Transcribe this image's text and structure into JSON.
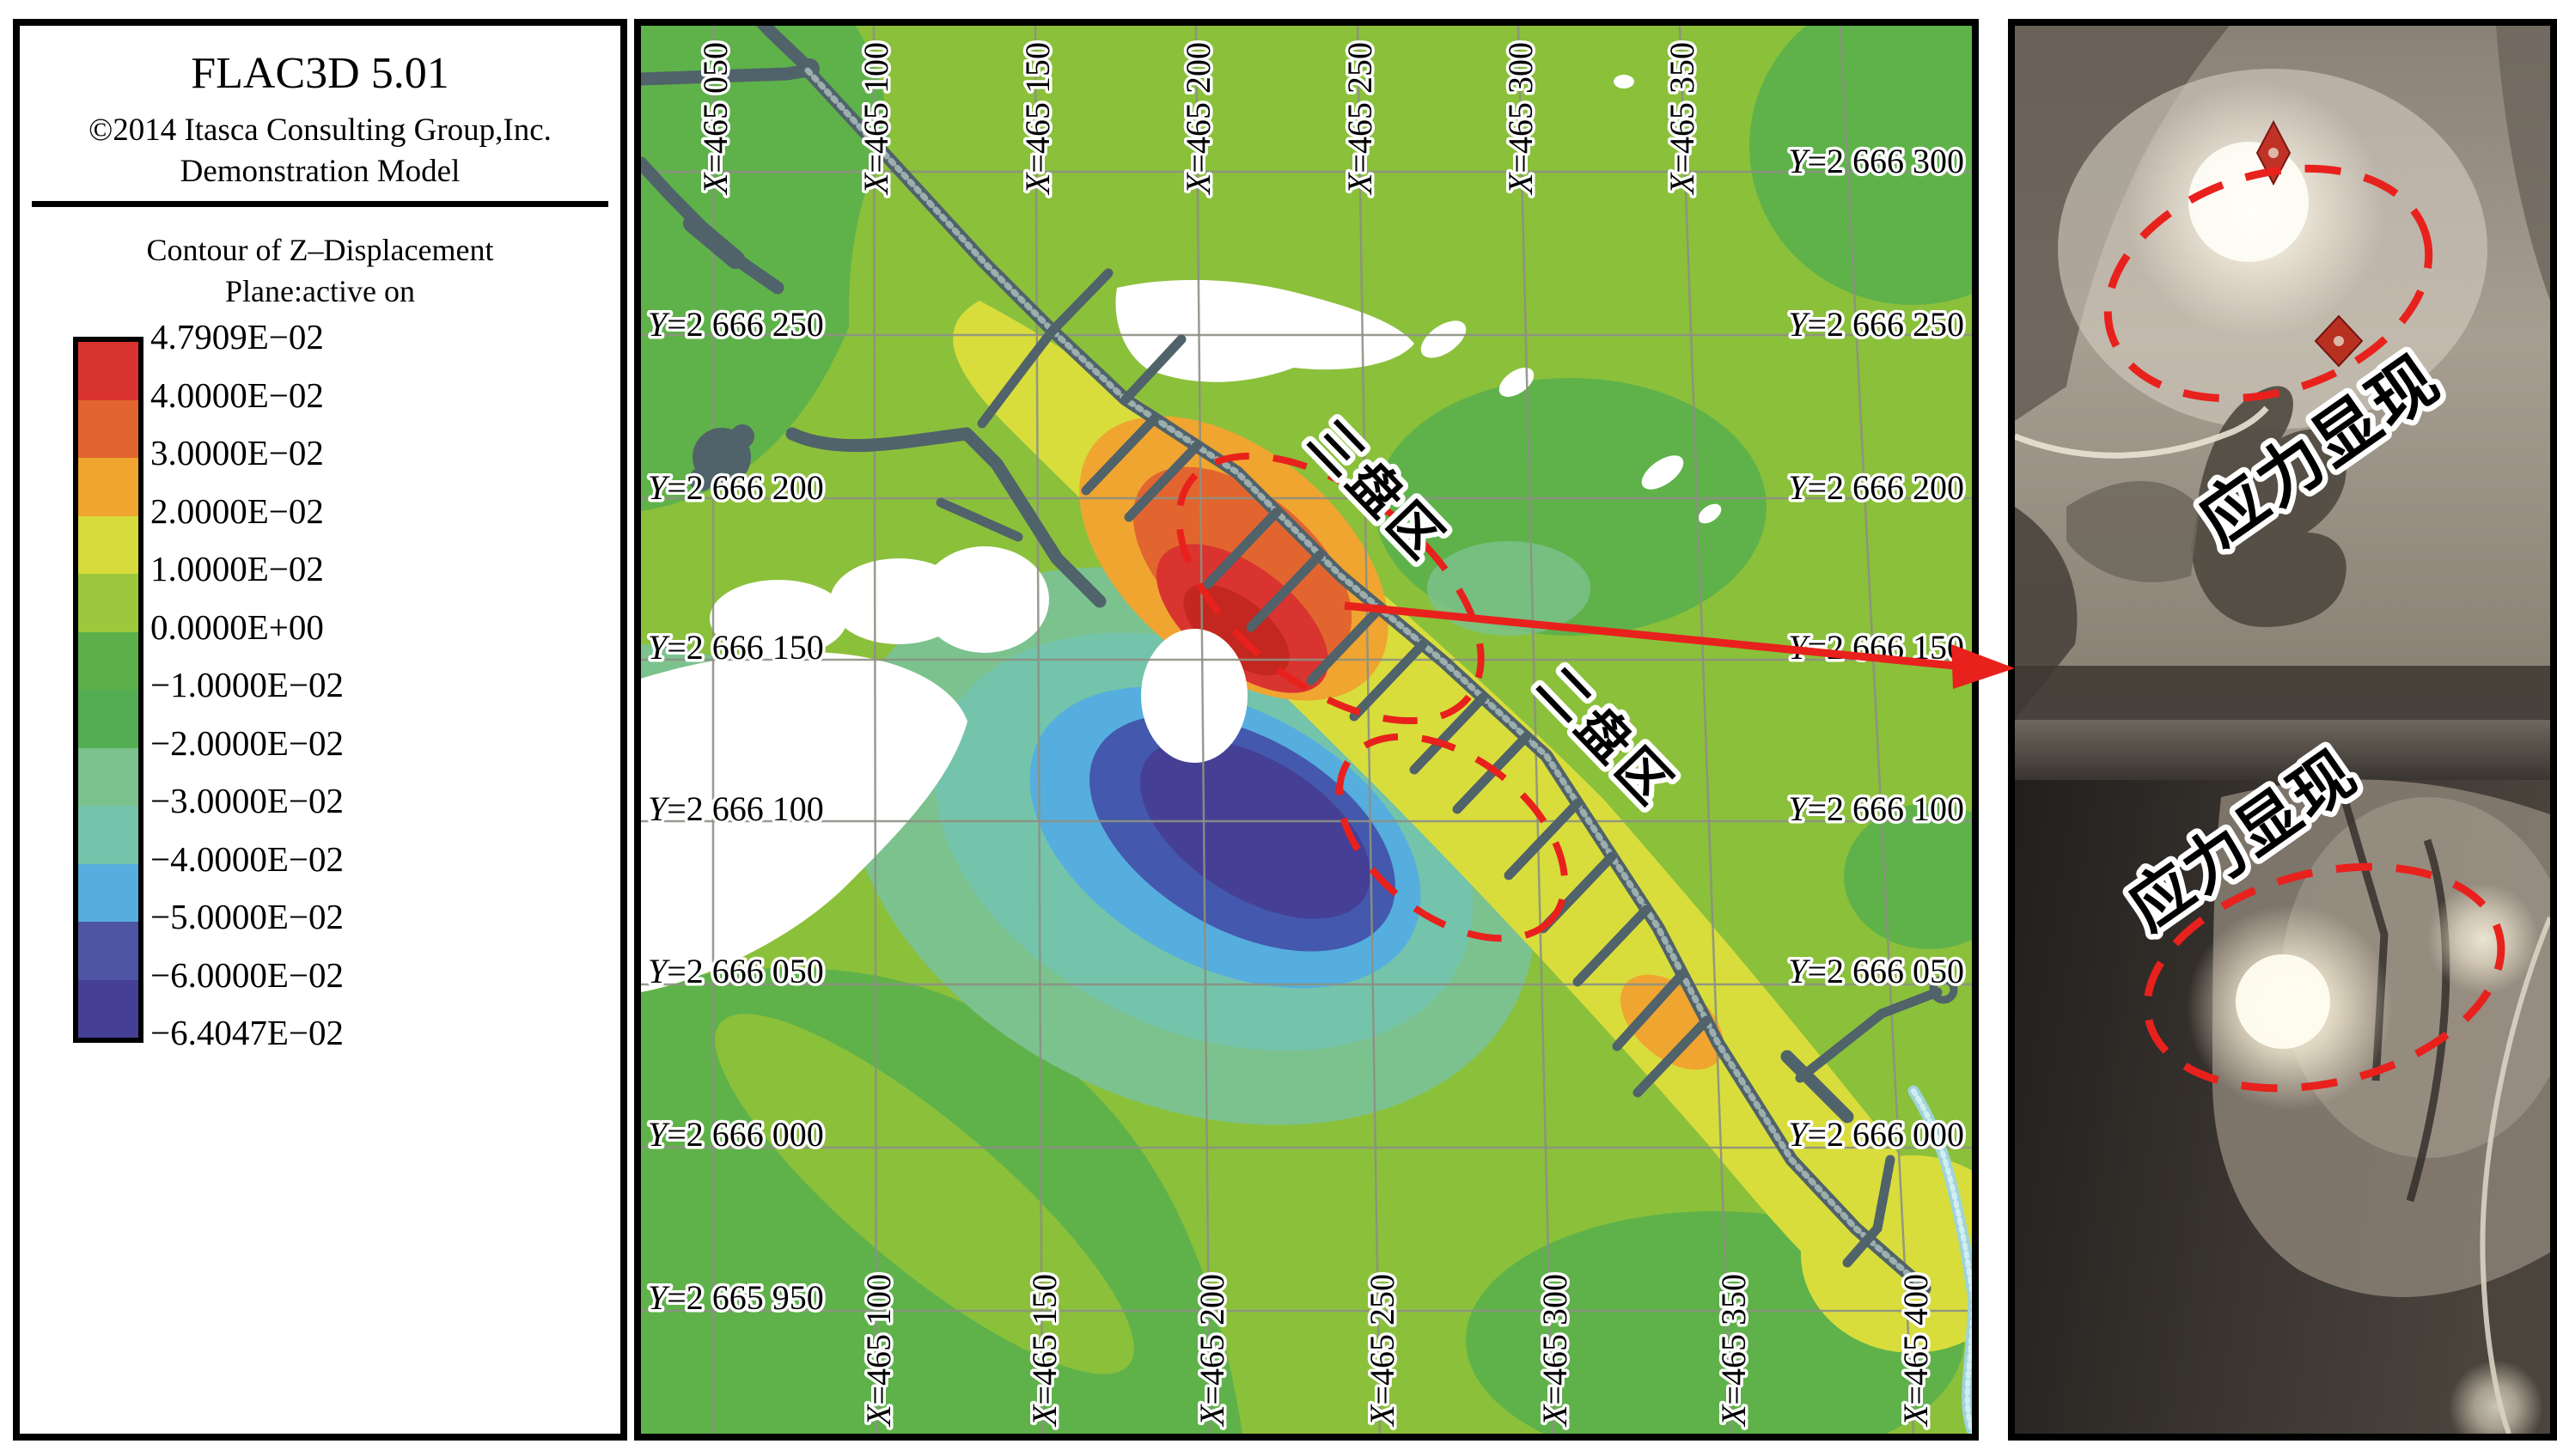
{
  "panel_header": {
    "title": "FLAC3D 5.01",
    "copyright": "©2014 Itasca Consulting Group,Inc.",
    "model": "Demonstration Model"
  },
  "legend": {
    "contour_title": "Contour of Z–Displacement",
    "plane": "Plane:active on",
    "labels": [
      "4.7909E−02",
      "4.0000E−02",
      "3.0000E−02",
      "2.0000E−02",
      "1.0000E−02",
      "0.0000E+00",
      "−1.0000E−02",
      "−2.0000E−02",
      "−3.0000E−02",
      "−4.0000E−02",
      "−5.0000E−02",
      "−6.0000E−02",
      "−6.4047E−02"
    ],
    "colors": [
      "#d93430",
      "#e2652f",
      "#f0a530",
      "#d6dc3b",
      "#9cc83e",
      "#5cb04b",
      "#54ad52",
      "#7cc28e",
      "#74c4ab",
      "#55aedd",
      "#4d55a4",
      "#453f96"
    ]
  },
  "map": {
    "top_labels": [
      {
        "k": "X",
        "v": "=465 050"
      },
      {
        "k": "X",
        "v": "=465 100"
      },
      {
        "k": "X",
        "v": "=465 150"
      },
      {
        "k": "X",
        "v": "=465 200"
      },
      {
        "k": "X",
        "v": "=465 250"
      },
      {
        "k": "X",
        "v": "=465 300"
      },
      {
        "k": "X",
        "v": "=465 350"
      }
    ],
    "bottom_labels": [
      {
        "k": "X",
        "v": "=465 100"
      },
      {
        "k": "X",
        "v": "=465 150"
      },
      {
        "k": "X",
        "v": "=465 200"
      },
      {
        "k": "X",
        "v": "=465 250"
      },
      {
        "k": "X",
        "v": "=465 300"
      },
      {
        "k": "X",
        "v": "=465 350"
      },
      {
        "k": "X",
        "v": "=465 400"
      }
    ],
    "left_labels": [
      {
        "k": "Y",
        "v": "=2 666 250"
      },
      {
        "k": "Y",
        "v": "=2 666 200"
      },
      {
        "k": "Y",
        "v": "=2 666 150"
      },
      {
        "k": "Y",
        "v": "=2 666 100"
      },
      {
        "k": "Y",
        "v": "=2 666 050"
      },
      {
        "k": "Y",
        "v": "=2 666 000"
      },
      {
        "k": "Y",
        "v": "=2 665 950"
      }
    ],
    "right_labels": [
      {
        "k": "Y",
        "v": "=2 666 300"
      },
      {
        "k": "Y",
        "v": "=2 666 250"
      },
      {
        "k": "Y",
        "v": "=2 666 200"
      },
      {
        "k": "Y",
        "v": "=2 666 150"
      },
      {
        "k": "Y",
        "v": "=2 666 100"
      },
      {
        "k": "Y",
        "v": "=2 666 050"
      },
      {
        "k": "Y",
        "v": "=2 666 000"
      }
    ],
    "zone_labels": {
      "zone3": "三盘区",
      "zone2": "二盘区"
    }
  },
  "photos": {
    "top": {
      "caption": "应力显现"
    },
    "bottom": {
      "caption": "应力显现"
    }
  },
  "chart_data": {
    "type": "heatmap",
    "title": "Contour of Z-Displacement (FLAC3D 5.01 Demonstration Model)",
    "plane": "Plane:active on",
    "xlabel": "X (m)",
    "ylabel": "Y (m)",
    "x_range": [
      465050,
      465400
    ],
    "y_range": [
      2665950,
      2666300
    ],
    "grid_interval_m": 50,
    "grid": true,
    "value_max": 0.047909,
    "value_min": -0.064047,
    "contour_levels": [
      0.047909,
      0.04,
      0.03,
      0.02,
      0.01,
      0.0,
      -0.01,
      -0.02,
      -0.03,
      -0.04,
      -0.05,
      -0.06,
      -0.064047
    ],
    "level_colors": [
      "#d93430",
      "#e2652f",
      "#f0a530",
      "#d6dc3b",
      "#9cc83e",
      "#5cb04b",
      "#54ad52",
      "#7cc28e",
      "#74c4ab",
      "#55aedd",
      "#4d55a4",
      "#453f96"
    ],
    "legend_position": "left",
    "features": [
      {
        "name": "uplift-hotspot-max",
        "value_range": [
          0.03,
          0.047909
        ],
        "x": 465215,
        "y": 2666160
      },
      {
        "name": "subsidence-bowl-min",
        "value_range": [
          -0.064047,
          -0.04
        ],
        "x": 465223,
        "y": 2666090
      },
      {
        "name": "panel-3 三盘区 (dashed ellipse)",
        "x": 465245,
        "y": 2666180
      },
      {
        "name": "panel-2 二盘区 (dashed ellipse)",
        "x": 465280,
        "y": 2666105
      },
      {
        "name": "red arrow from stress zone to field photos",
        "x": 465350,
        "y": 2666145
      }
    ]
  }
}
